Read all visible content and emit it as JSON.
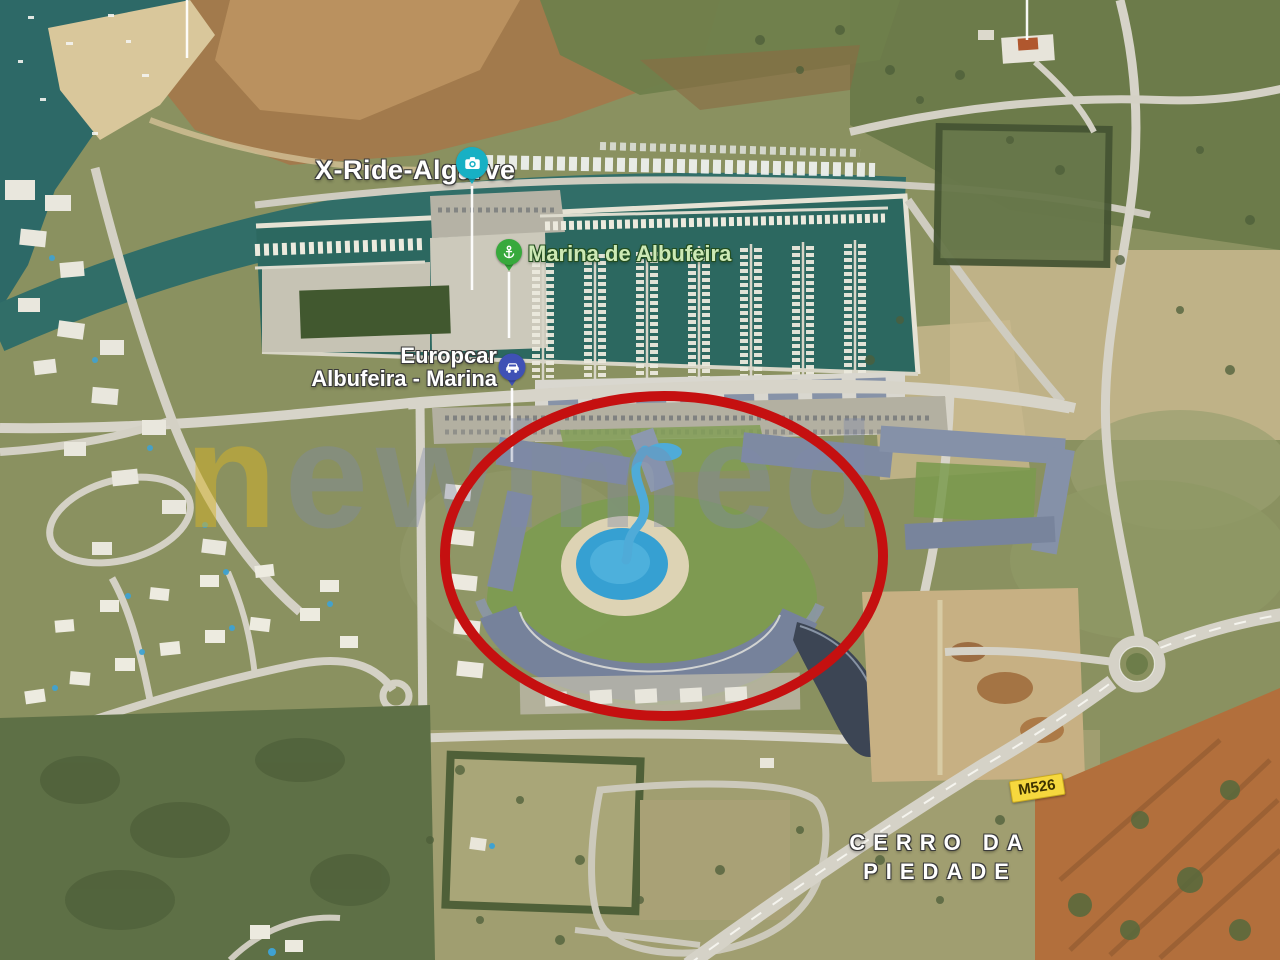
{
  "map": {
    "view": "satellite",
    "pins": {
      "xride": {
        "label": "X-Ride-Algarve",
        "color": "#17b0c4",
        "icon": "camera"
      },
      "marina": {
        "label": "Marina de Albufeira",
        "color": "#37a93c",
        "icon": "anchor",
        "label_color": "#cde9b5"
      },
      "europcar": {
        "label_line1": "Europcar",
        "label_line2": "Albufeira - Marina",
        "color": "#3f51b5",
        "icon": "car"
      }
    },
    "area_label": {
      "line1": "CERRO DA",
      "line2": "PIEDADE"
    },
    "road_badge": {
      "text": "M526",
      "background": "#f6d83e"
    },
    "annotation_circle": {
      "shape": "ellipse",
      "color": "#c51010"
    },
    "watermark": {
      "first": "n",
      "rest": "ewimed",
      "first_color": "#d6b426",
      "rest_color": "#7d88aa"
    }
  }
}
